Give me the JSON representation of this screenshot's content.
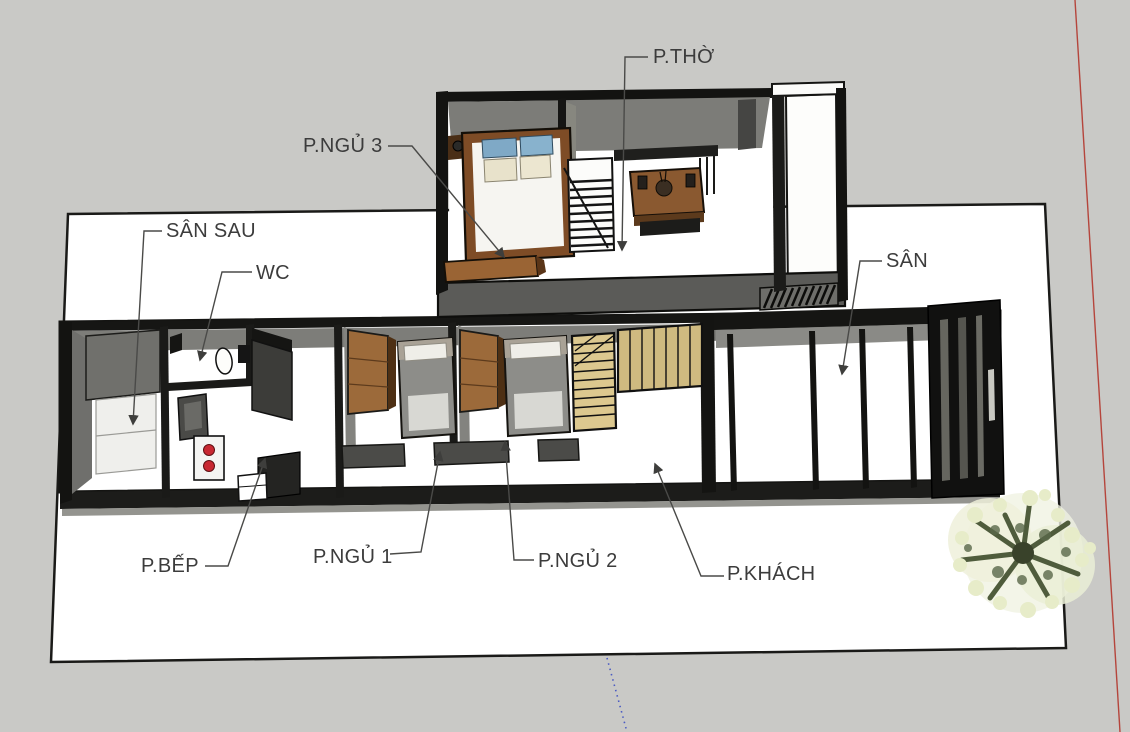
{
  "scene": {
    "description": "3D cutaway dollhouse floor plan of a two-storey house viewed from above",
    "floors": [
      "ground",
      "upper"
    ]
  },
  "labels": {
    "p_tho": "P.THỜ",
    "p_ngu_3": "P.NGỦ 3",
    "san_sau": "SÂN SAU",
    "wc": "WC",
    "san": "SÂN",
    "p_bep": "P.BẾP",
    "p_ngu_1": "P.NGỦ 1",
    "p_ngu_2": "P.NGỦ 2",
    "p_khach": "P.KHÁCH"
  },
  "rooms": [
    {
      "id": "p-tho",
      "label": "P.THỜ",
      "floor": "upper"
    },
    {
      "id": "p-ngu-3",
      "label": "P.NGỦ 3",
      "floor": "upper"
    },
    {
      "id": "san-sau",
      "label": "SÂN SAU",
      "floor": "ground"
    },
    {
      "id": "wc",
      "label": "WC",
      "floor": "ground"
    },
    {
      "id": "p-bep",
      "label": "P.BẾP",
      "floor": "ground"
    },
    {
      "id": "p-ngu-1",
      "label": "P.NGỦ 1",
      "floor": "ground"
    },
    {
      "id": "p-ngu-2",
      "label": "P.NGỦ 2",
      "floor": "ground"
    },
    {
      "id": "p-khach",
      "label": "P.KHÁCH",
      "floor": "ground"
    },
    {
      "id": "san",
      "label": "SÂN",
      "floor": "ground"
    }
  ],
  "colors": {
    "background": "#c9c9c6",
    "ground_plane": "#ffffff",
    "wall_face_gray": "#7c7c78",
    "cut_wall_black": "#161614",
    "wood_brown": "#9a6434",
    "stair_wood_tan": "#d9c68e",
    "stove_burner_red": "#c82832",
    "pillow_blue": "#84adc9",
    "axis_red": "#b5453c",
    "axis_blue": "#4a5ac2",
    "label_text": "#3c3c3c"
  }
}
